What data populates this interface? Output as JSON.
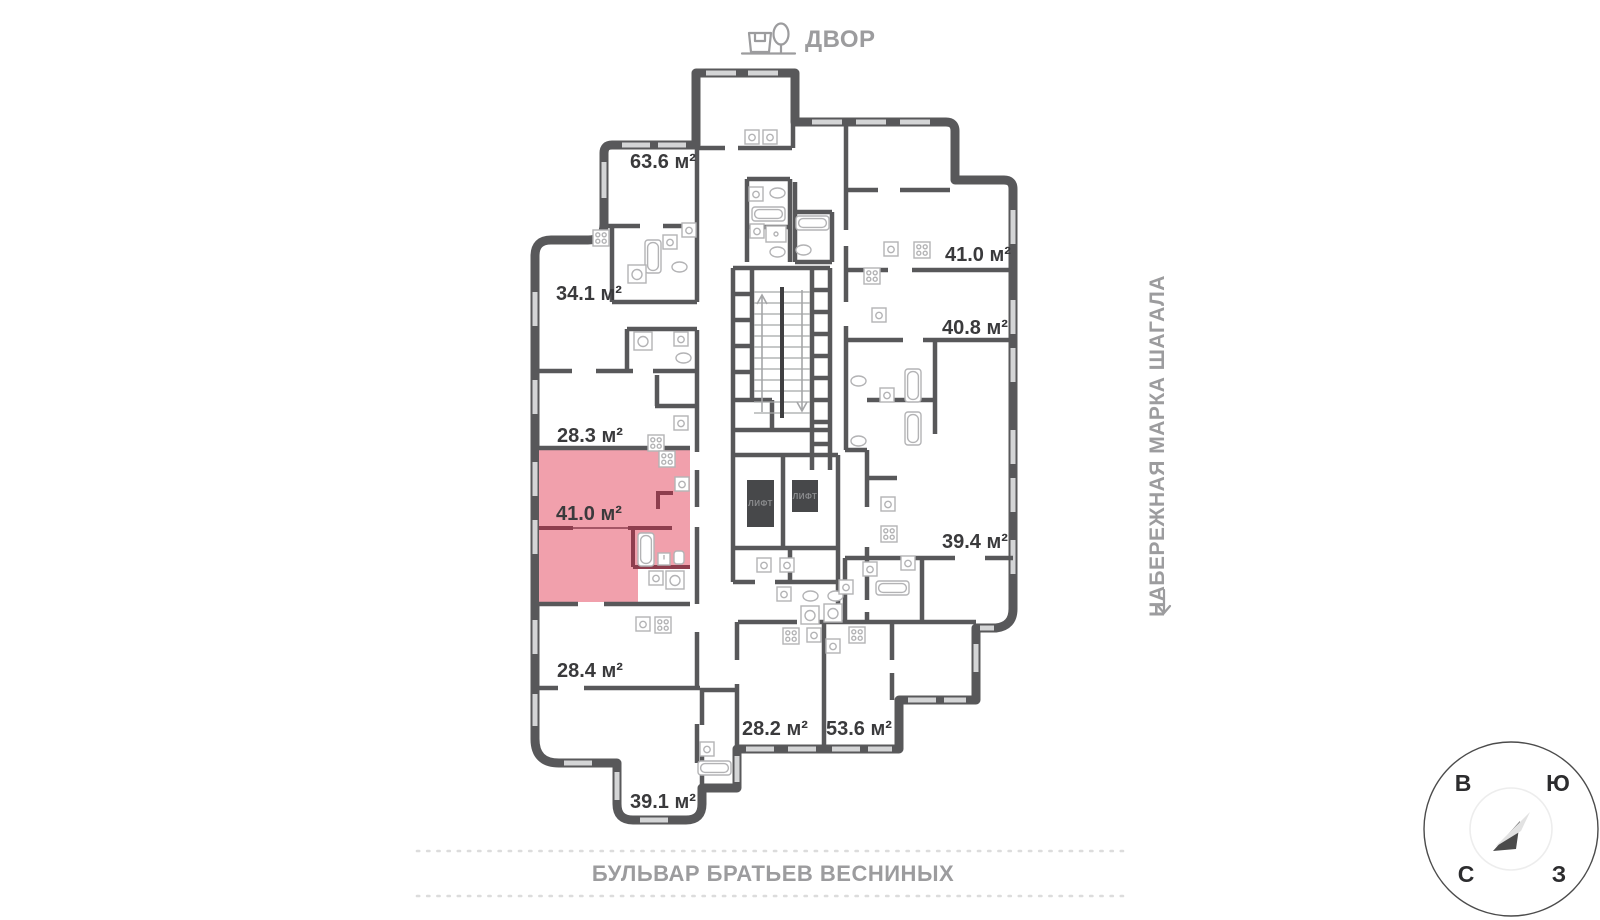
{
  "floor_plan": {
    "apartments": [
      {
        "area": "63.6 м²",
        "highlighted": false
      },
      {
        "area": "34.1 м²",
        "highlighted": false
      },
      {
        "area": "28.3 м²",
        "highlighted": false
      },
      {
        "area": "41.0 м²",
        "highlighted": true
      },
      {
        "area": "28.4 м²",
        "highlighted": false
      },
      {
        "area": "39.1 м²",
        "highlighted": false
      },
      {
        "area": "28.2 м²",
        "highlighted": false
      },
      {
        "area": "53.6 м²",
        "highlighted": false
      },
      {
        "area": "41.0 м²",
        "highlighted": false
      },
      {
        "area": "40.8 м²",
        "highlighted": false
      },
      {
        "area": "39.4 м²",
        "highlighted": false
      }
    ],
    "elevator_label": "ЛИФТ",
    "colors": {
      "wall": "#58585a",
      "highlight_fill": "#f1a0ac",
      "highlight_wall": "#8e3e4e",
      "elevator_fill": "#47484a",
      "street_text": "#9c9c9e",
      "label_text": "#3a3a3c"
    }
  },
  "landmarks": {
    "courtyard": "ДВОР",
    "embankment": "НАБЕРЕЖНАЯ МАРКА ШАГАЛА",
    "boulevard": "БУЛЬВАР БРАТЬЕВ ВЕСНИНЫХ"
  },
  "compass": {
    "east": "В",
    "south": "Ю",
    "north": "С",
    "west": "З"
  }
}
